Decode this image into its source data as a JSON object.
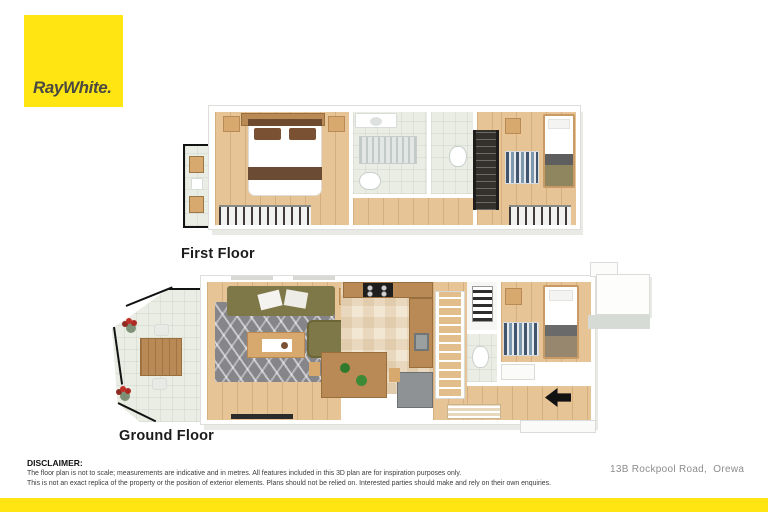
{
  "colors": {
    "brand-yellow": "#FFE512",
    "logo-text": "#4A4A42",
    "wood-floor": "#E7C495",
    "wood-dark": "#B98A55",
    "tile-pale": "#E9EDE3",
    "tile-cream": "#F2E7D2",
    "sofa-olive": "#7E7748",
    "rug-gray": "#85858A",
    "flower-red": "#C03028",
    "accent-black": "#121212",
    "text-gray": "#8D8D8D"
  },
  "logo": {
    "brand": "RayWhite."
  },
  "plans": {
    "first": {
      "label": "First Floor"
    },
    "ground": {
      "label": "Ground Floor"
    }
  },
  "footer": {
    "disclaimer_title": "DISCLAIMER:",
    "disclaimer_line1": "The floor plan is not to scale; measurements are indicative and in metres. All features included in this 3D plan are for inspiration purposes only.",
    "disclaimer_line2": "This is not an exact replica of the property or the position of exterior elements. Plans should not be relied on. Interested parties should make and rely on their own enquiries.",
    "address": "13B Rockpool Road,  Orewa"
  }
}
